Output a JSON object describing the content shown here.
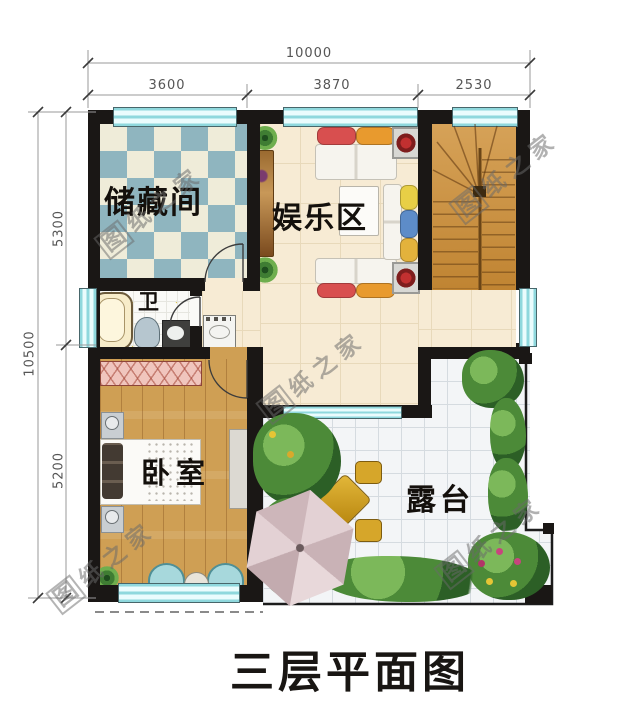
{
  "title": "三层平面图",
  "watermark": {
    "first": "图",
    "rest": "纸之家"
  },
  "dimensions": {
    "top": {
      "total": "10000",
      "segments": [
        "3600",
        "3870",
        "2530"
      ]
    },
    "left": {
      "total": "10500",
      "segments": [
        "5300",
        "5200"
      ]
    }
  },
  "rooms": {
    "storage": "储藏间",
    "entertainment": "娱乐区",
    "bathroom": "卫",
    "bedroom": "卧室",
    "terrace": "露台"
  },
  "colors": {
    "wall": "#1a1715",
    "window": "#bfeef0",
    "stair_wood": "#c8934a",
    "bedroom_wood": "#cf9f54",
    "checker_blue": "#8fb5bf",
    "checker_cream": "#efecd9",
    "terrace_tile": "#f3f5f7",
    "umbrella": "#dccbce",
    "pillow_red": "#d84f4f",
    "pillow_orange": "#e89a2e",
    "pillow_yellow": "#e8cf46",
    "pillow_blue": "#5d8cc8"
  }
}
